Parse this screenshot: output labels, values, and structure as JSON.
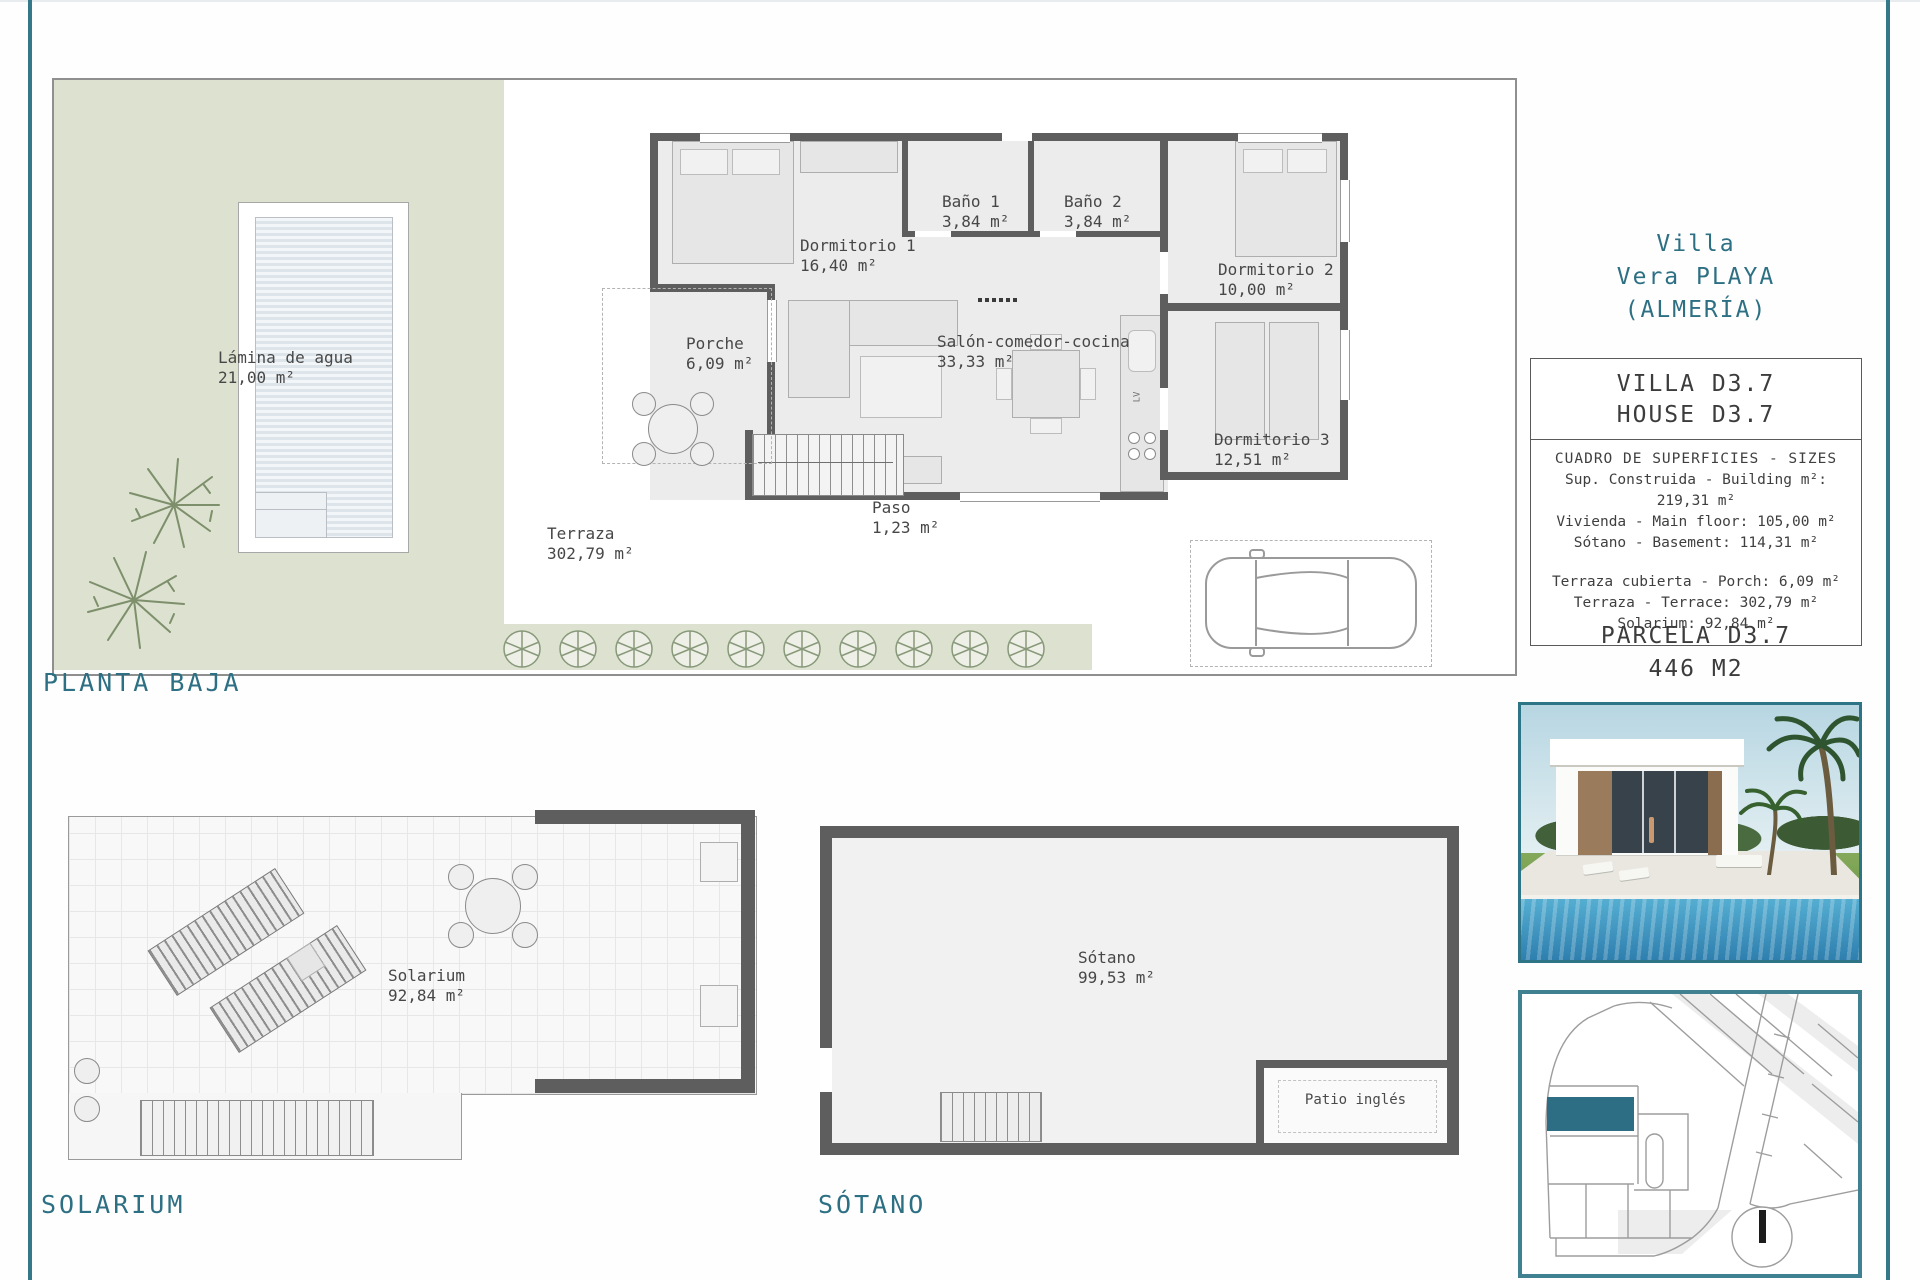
{
  "colors": {
    "accent_teal": "#2d7084",
    "map_highlight": "#2d6e84",
    "garden_green": "#dde1d0",
    "wall_gray": "#5e5e5e"
  },
  "plans": {
    "planta_baja": {
      "label": "PLANTA BAJA",
      "rooms": [
        {
          "name": "Lámina de agua",
          "area": "21,00 m²"
        },
        {
          "name": "Porche",
          "area": "6,09 m²"
        },
        {
          "name": "Terraza",
          "area": "302,79 m²"
        },
        {
          "name": "Dormitorio 1",
          "area": "16,40 m²"
        },
        {
          "name": "Baño 1",
          "area": "3,84 m²"
        },
        {
          "name": "Baño 2",
          "area": "3,84 m²"
        },
        {
          "name": "Dormitorio 2",
          "area": "10,00 m²"
        },
        {
          "name": "Salón-comedor-cocina",
          "area": "33,33 m²"
        },
        {
          "name": "Dormitorio 3",
          "area": "12,51 m²"
        },
        {
          "name": "Paso",
          "area": "1,23 m²"
        }
      ],
      "kitchen_label": "LV"
    },
    "solarium": {
      "label": "SOLARIUM",
      "room": {
        "name": "Solarium",
        "area": "92,84 m²"
      }
    },
    "sotano": {
      "label": "SÓTANO",
      "room": {
        "name": "Sótano",
        "area": "99,53 m²"
      },
      "patio_label": "Patio inglés"
    }
  },
  "sidebar": {
    "title_lines": [
      "Villa",
      "Vera PLAYA",
      "(ALMERÍA)"
    ],
    "info_box": {
      "title_lines": [
        "VILLA D3.7",
        "HOUSE D3.7"
      ],
      "table_header": "CUADRO DE SUPERFICIES  - SIZES",
      "rows_a": [
        "Sup. Construida  - Building m²: 219,31 m²",
        "Vivienda  - Main floor: 105,00 m²",
        "Sótano  - Basement: 114,31 m²"
      ],
      "rows_b": [
        "Terraza cubierta  - Porch: 6,09 m²",
        "Terraza  - Terrace: 302,79 m²",
        "Solarium: 92,84 m²"
      ]
    },
    "parcela_lines": [
      "PARCELA D3.7",
      "446 M2"
    ]
  }
}
